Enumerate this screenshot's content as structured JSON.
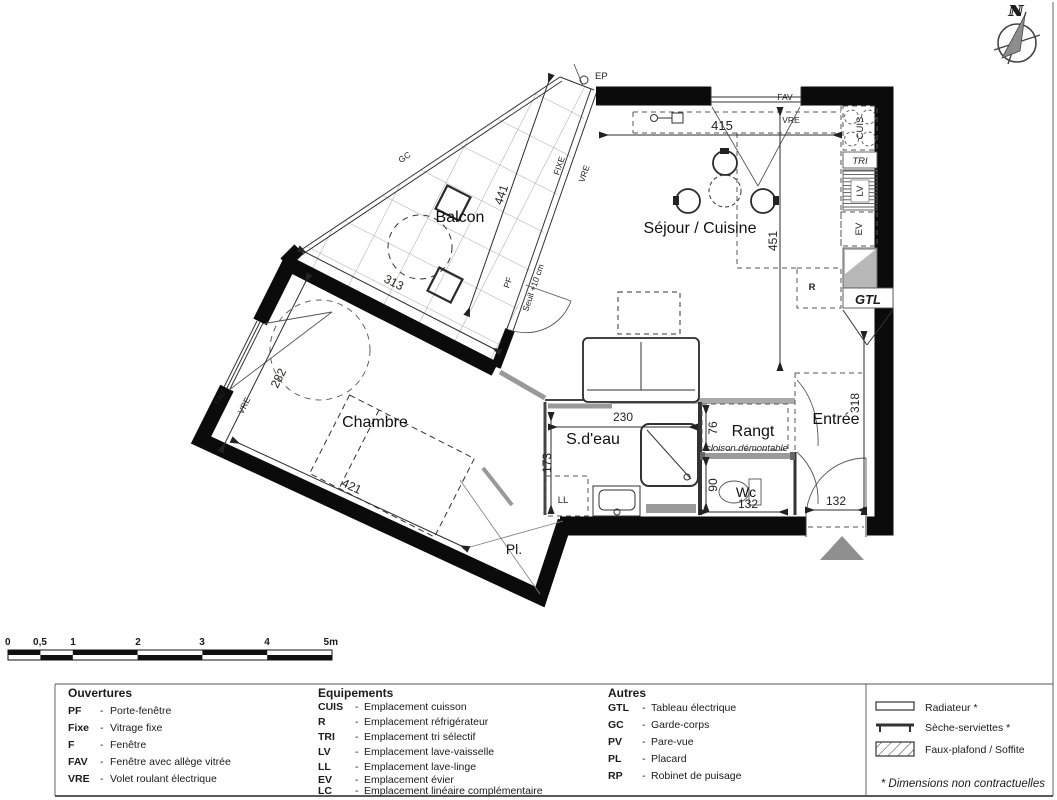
{
  "sheet": {
    "compass_n": "N",
    "note": "* Dimensions non contractuelles"
  },
  "plan": {
    "rooms": {
      "balcon": "Balcon",
      "sejour": "Séjour / Cuisine",
      "chambre": "Chambre",
      "sdeau": "S.d'eau",
      "rangt": "Rangt",
      "entree": "Entrée",
      "wc": "Wc",
      "pl": "Pl."
    },
    "dims": {
      "d415": "415",
      "d451": "451",
      "d441": "441",
      "d313": "313",
      "d282": "282",
      "d421": "421",
      "d230": "230",
      "d173": "173",
      "d76": "76",
      "d90": "90",
      "d132_wc": "132",
      "d132_entree": "132",
      "d318": "318"
    },
    "tags": {
      "ep": "EP",
      "fav_top": "FAV",
      "vre_top": "VRE",
      "cuis": "CUIS",
      "tri": "TRI",
      "lv": "LV",
      "ev": "EV",
      "r": "R",
      "gtl": "GTL",
      "fixe": "FIXE",
      "vre_facade": "VRE",
      "pf": "PF",
      "seuil": "Seuil +10 cm",
      "gc": "GC",
      "fav_chambre": "FAV",
      "vre_chambre": "VRE",
      "ll": "LL",
      "cloison": "cloison démontable"
    }
  },
  "scalebar": {
    "ticks": [
      "0",
      "0,5",
      "1",
      "2",
      "3",
      "4",
      "5m"
    ]
  },
  "legend": {
    "sep": "-",
    "ouvertures": {
      "title": "Ouvertures",
      "items": [
        {
          "abbr": "PF",
          "desc": "Porte-fenêtre"
        },
        {
          "abbr": "Fixe",
          "desc": "Vitrage fixe"
        },
        {
          "abbr": "F",
          "desc": "Fenêtre"
        },
        {
          "abbr": "FAV",
          "desc": "Fenêtre avec allège vitrée"
        },
        {
          "abbr": "VRE",
          "desc": "Volet roulant électrique"
        }
      ]
    },
    "equipements": {
      "title": "Equipements",
      "items": [
        {
          "abbr": "CUIS",
          "desc": "Emplacement cuisson"
        },
        {
          "abbr": "R",
          "desc": "Emplacement réfrigérateur"
        },
        {
          "abbr": "TRI",
          "desc": "Emplacement tri sélectif"
        },
        {
          "abbr": "LV",
          "desc": "Emplacement lave-vaisselle"
        },
        {
          "abbr": "LL",
          "desc": "Emplacement lave-linge"
        },
        {
          "abbr": "EV",
          "desc": "Emplacement évier"
        },
        {
          "abbr": "LC",
          "desc": "Emplacement linéaire complémentaire"
        }
      ]
    },
    "autres": {
      "title": "Autres",
      "items": [
        {
          "abbr": "GTL",
          "desc": "Tableau électrique"
        },
        {
          "abbr": "GC",
          "desc": "Garde-corps"
        },
        {
          "abbr": "PV",
          "desc": "Pare-vue"
        },
        {
          "abbr": "PL",
          "desc": "Placard"
        },
        {
          "abbr": "RP",
          "desc": "Robinet de puisage"
        }
      ]
    },
    "symbols": [
      {
        "id": "radiateur",
        "label": "Radiateur *"
      },
      {
        "id": "seche-serviettes",
        "label": "Sèche-serviettes *"
      },
      {
        "id": "faux-plafond",
        "label": "Faux-plafond / Soffite"
      }
    ]
  }
}
